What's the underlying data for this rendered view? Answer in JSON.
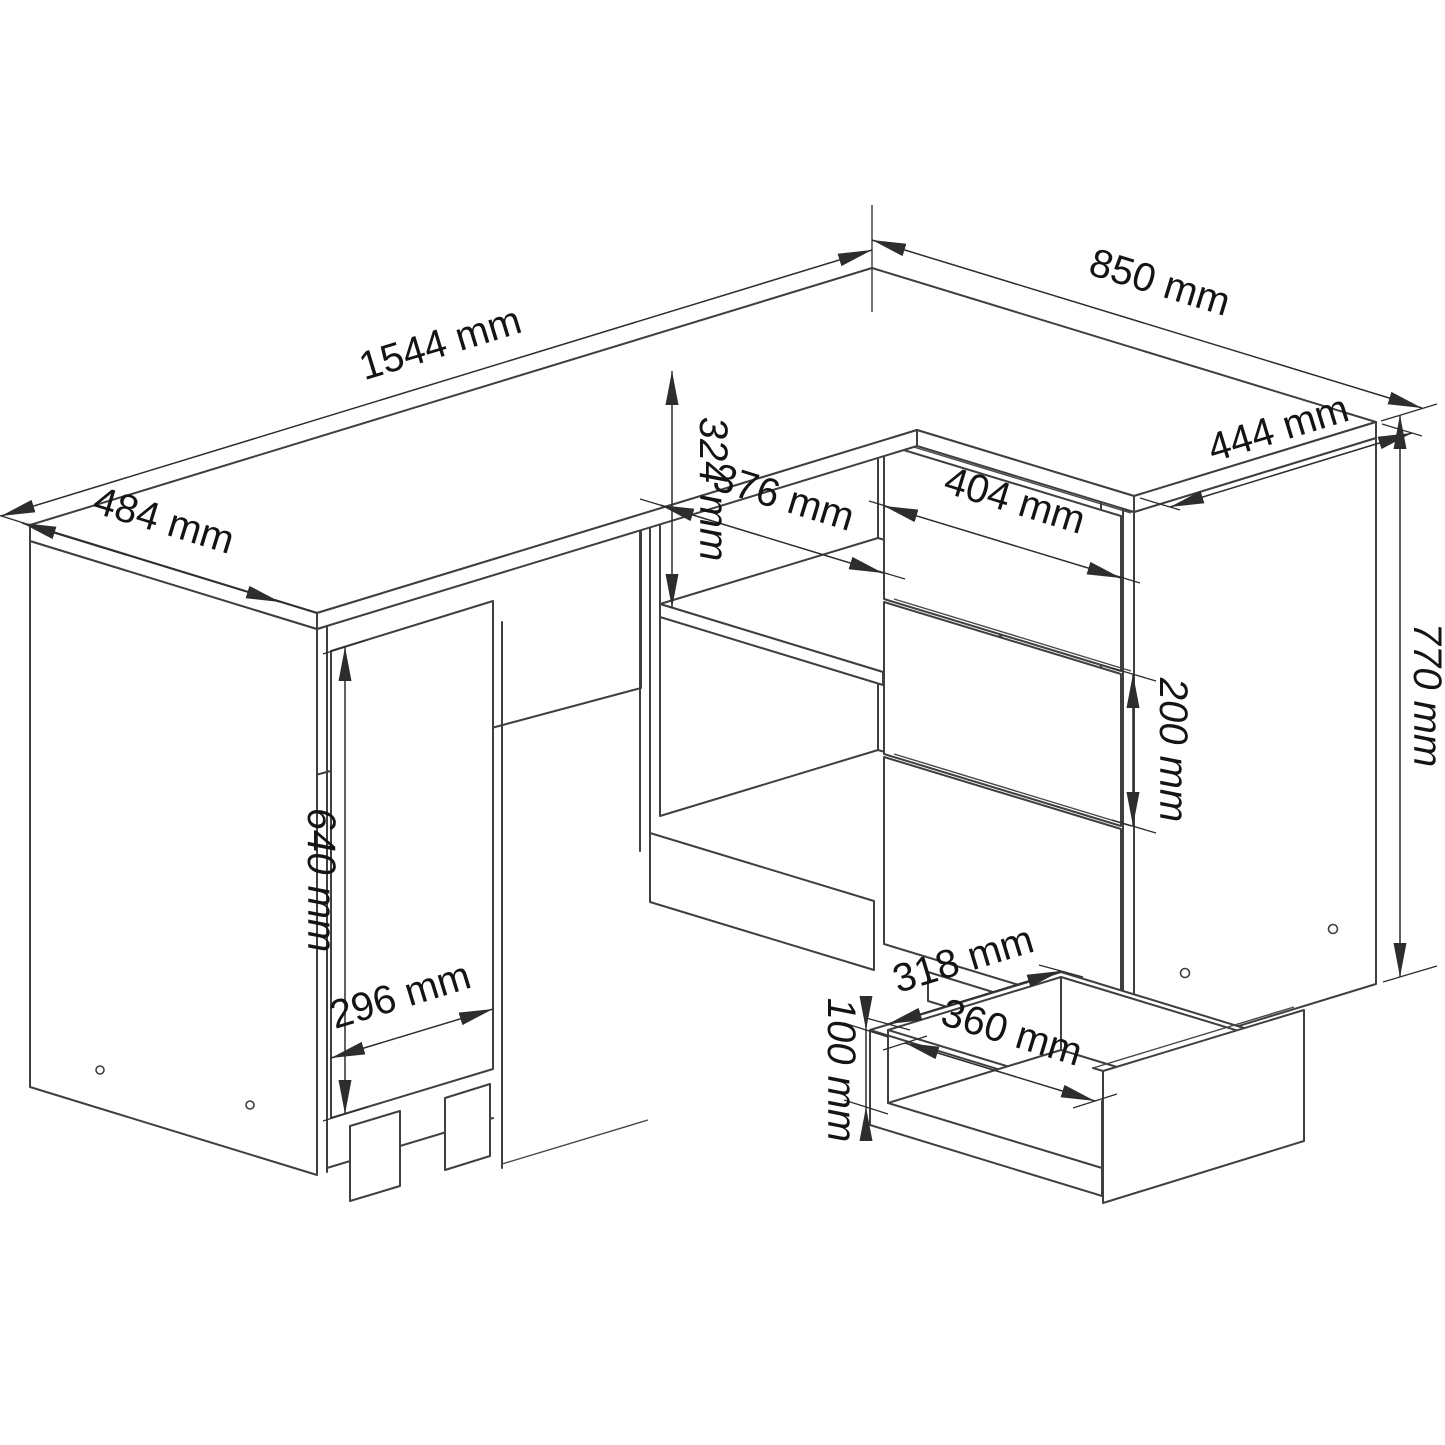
{
  "drawing": {
    "kind": "isometric-technical-drawing",
    "subject": "corner desk with cabinet door, open shelf, three-drawer unit and pulled-out drawer",
    "unit": "mm",
    "background_color": "#ffffff",
    "line_color": "#3f3f3f",
    "text_color": "#141414"
  },
  "dims": {
    "desk_length": {
      "label": "1544 mm",
      "value": 1544
    },
    "desk_depth_left": {
      "label": "484 mm",
      "value": 484
    },
    "return_length": {
      "label": "850 mm",
      "value": 850
    },
    "return_width": {
      "label": "444 mm",
      "value": 444
    },
    "total_height": {
      "label": "770 mm",
      "value": 770
    },
    "door_height": {
      "label": "640 mm",
      "value": 640
    },
    "door_width": {
      "label": "296 mm",
      "value": 296
    },
    "shelf_width": {
      "label": "376 mm",
      "value": 376
    },
    "shelf_height": {
      "label": "324 mm",
      "value": 324
    },
    "drawer_front_width": {
      "label": "404 mm",
      "value": 404
    },
    "drawer_front_height": {
      "label": "200 mm",
      "value": 200
    },
    "drawer_inner_width": {
      "label": "318 mm",
      "value": 318
    },
    "drawer_inner_depth": {
      "label": "360 mm",
      "value": 360
    },
    "drawer_inner_height": {
      "label": "100 mm",
      "value": 100
    }
  }
}
